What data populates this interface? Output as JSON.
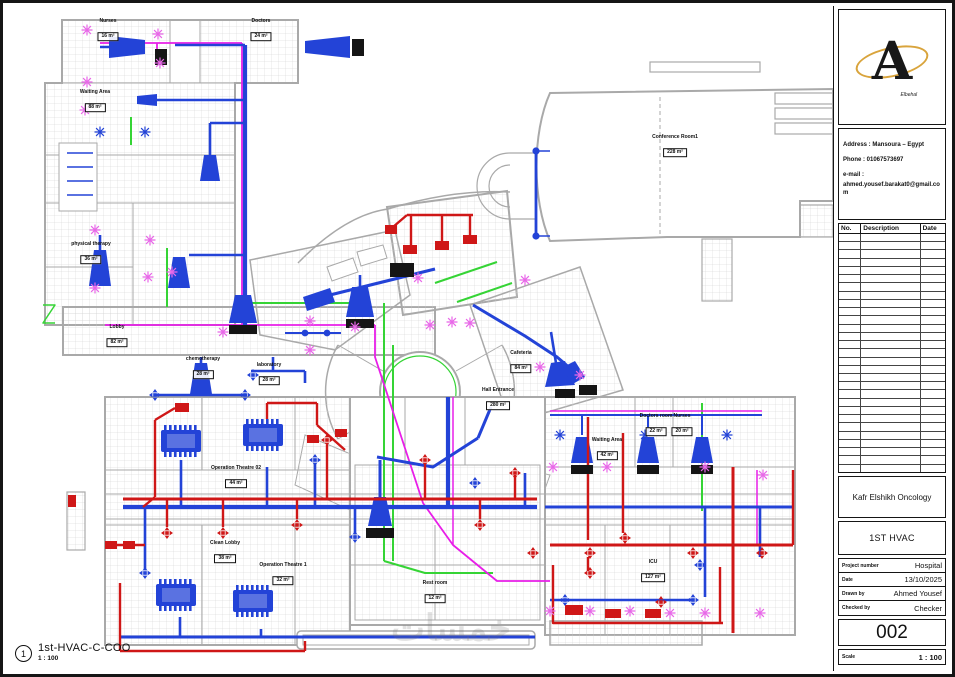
{
  "sheet": {
    "view_marker": {
      "number": "1",
      "title": "1st-HVAC-C-COO",
      "scale": "1 : 100"
    },
    "watermark": "خمسات"
  },
  "title_block": {
    "logo": {
      "monogram": "A",
      "brand": "Elbehal"
    },
    "contact": {
      "address": "Address : Mansoura – Egypt",
      "phone": "Phone : 01067573697",
      "email_label": "e-mail :",
      "email": "ahmed.yousef.barakat0@gmail.com"
    },
    "revision_table": {
      "headers": [
        "No.",
        "Description",
        "Date"
      ],
      "row_count": 29
    },
    "project_name": "Kafr Elshikh Oncology",
    "sheet_title": "1ST HVAC",
    "fields": [
      {
        "label": "Project number",
        "value": "Hospital"
      },
      {
        "label": "Date",
        "value": "13/10/2025"
      },
      {
        "label": "Drawn by",
        "value": "Ahmed Yousef"
      },
      {
        "label": "Checked by",
        "value": "Checker"
      }
    ],
    "sheet_number": "002",
    "scale_label": "Scale",
    "scale_value": "1 : 100"
  },
  "plan": {
    "rooms": [
      {
        "name": "Nurses",
        "area": "16 m²",
        "x": 103,
        "y": 24
      },
      {
        "name": "Doctors",
        "area": "24 m²",
        "x": 256,
        "y": 24
      },
      {
        "name": "Waiting Area",
        "area": "88 m²",
        "x": 90,
        "y": 95
      },
      {
        "name": "physical therapy",
        "area": "36 m²",
        "x": 86,
        "y": 247
      },
      {
        "name": "Lobby",
        "area": "82 m²",
        "x": 112,
        "y": 330
      },
      {
        "name": "chemotherapy",
        "area": "28 m²",
        "x": 198,
        "y": 362
      },
      {
        "name": "laboratory",
        "area": "28 m²",
        "x": 264,
        "y": 368
      },
      {
        "name": "Conference Room1",
        "area": "228 m²",
        "x": 670,
        "y": 140
      },
      {
        "name": "Cafeteria",
        "area": "84 m²",
        "x": 516,
        "y": 356
      },
      {
        "name": "Hall Entrance",
        "area": "280 m²",
        "x": 493,
        "y": 393
      },
      {
        "name": "Operation Theatre 02",
        "area": "44 m²",
        "x": 231,
        "y": 471
      },
      {
        "name": "Clean Lobby",
        "area": "38 m²",
        "x": 220,
        "y": 546
      },
      {
        "name": "Operation Theatre 1",
        "area": "32 m²",
        "x": 278,
        "y": 568
      },
      {
        "name": "Rest room",
        "area": "12 m²",
        "x": 430,
        "y": 586
      },
      {
        "name": "Waiting Area",
        "area": "42 m²",
        "x": 602,
        "y": 443
      },
      {
        "name": "Doctors room",
        "area": "22 m²",
        "x": 651,
        "y": 419
      },
      {
        "name": "Nurses",
        "area": "20 m²",
        "x": 677,
        "y": 419
      },
      {
        "name": "ICU",
        "area": "127 m²",
        "x": 648,
        "y": 565
      }
    ]
  },
  "colors": {
    "supply_duct": "#2343d7",
    "exhaust_duct": "#cf1717",
    "pipe": "#e81ee8",
    "pipe_light": "#e868e8",
    "drain": "#35d435",
    "walls": "#a9a9a9",
    "hatch": "#cfcfcf",
    "accent_gold": "#d9a43c"
  }
}
